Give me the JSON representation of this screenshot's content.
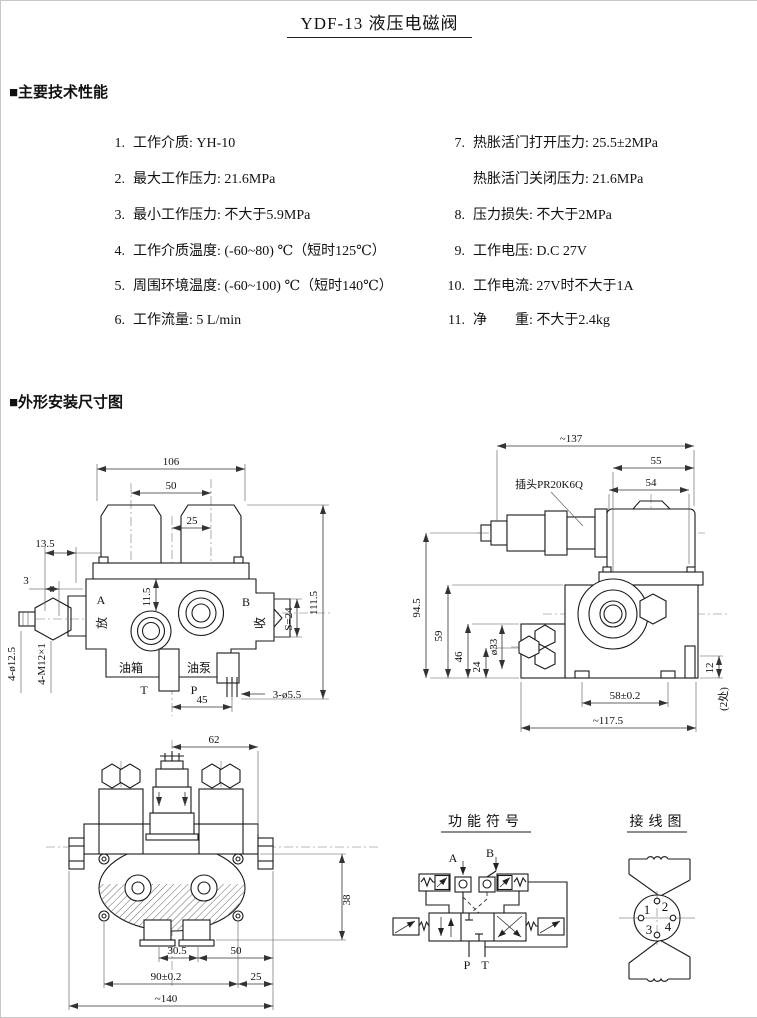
{
  "page": {
    "title": "YDF-13 液压电磁阀"
  },
  "sections": {
    "specs": "■主要技术性能",
    "dims": "■外形安装尺寸图"
  },
  "specs": {
    "left": [
      {
        "num": "1.",
        "text": "工作介质: YH-10"
      },
      {
        "num": "2.",
        "text": "最大工作压力: 21.6MPa"
      },
      {
        "num": "3.",
        "text": "最小工作压力: 不大于5.9MPa"
      },
      {
        "num": "4.",
        "text": "工作介质温度: (-60~80) ℃（短时125℃）"
      },
      {
        "num": "5.",
        "text": "周围环境温度: (-60~100) ℃（短时140℃）"
      },
      {
        "num": "6.",
        "text": "工作流量: 5 L/min"
      }
    ],
    "right": [
      {
        "num": "7.",
        "text": "热胀活门打开压力: 25.5±2MPa"
      },
      {
        "num": "",
        "text": "热胀活门关闭压力: 21.6MPa"
      },
      {
        "num": "8.",
        "text": "压力损失: 不大于2MPa"
      },
      {
        "num": "9.",
        "text": "工作电压: D.C 27V"
      },
      {
        "num": "10.",
        "text": "工作电流: 27V时不大于1A"
      },
      {
        "num": "11.",
        "text": "净　　重: 不大于2.4kg"
      }
    ]
  },
  "front_view": {
    "d106": "106",
    "d50": "50",
    "d25": "25",
    "d13_5": "13.5",
    "d3": "3",
    "d11_5": "11.5",
    "d111_5": "111.5",
    "s24": "S=24",
    "d45": "45",
    "holes": "3-ø5.5",
    "bolts": "4-ø12.5",
    "threads": "4-M12×1",
    "a": "A",
    "b": "B",
    "fang": "放",
    "shou": "收",
    "tank": "油箱",
    "pump": "油泵",
    "t": "T",
    "p": "P"
  },
  "side_view": {
    "d137": "~137",
    "d55": "55",
    "d54": "54",
    "plug": "插头PR20K6Q",
    "d94_5": "94.5",
    "d59": "59",
    "d46": "46",
    "d24": "24",
    "d33": "ø33",
    "d58": "58±0.2",
    "d117": "~117.5",
    "d12": "12",
    "two_places": "(2处)"
  },
  "top_view": {
    "d62": "62",
    "d38": "38",
    "d30_5": "30.5",
    "d50": "50",
    "d90": "90±0.2",
    "d25": "25",
    "d140": "~140"
  },
  "schematic": {
    "title": "功能符号",
    "a": "A",
    "b": "B",
    "p": "P",
    "t": "T"
  },
  "wiring": {
    "title": "接线图",
    "pin1": "1",
    "pin2": "2",
    "pin3": "3",
    "pin4": "4"
  }
}
